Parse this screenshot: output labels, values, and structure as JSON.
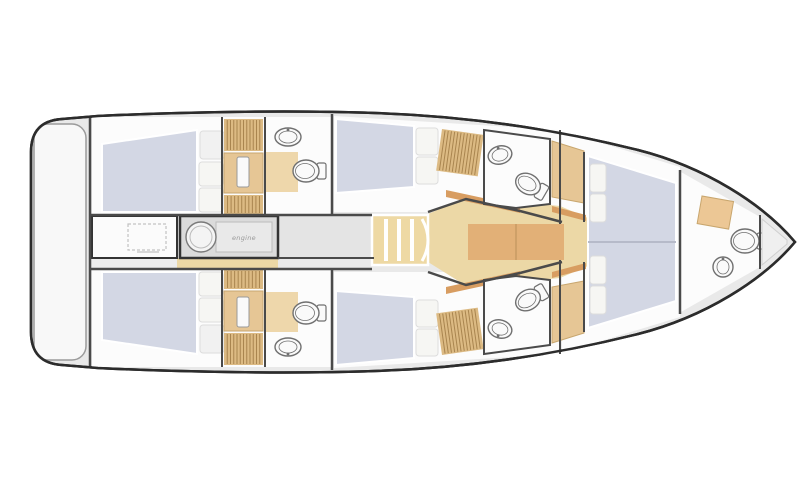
{
  "labels": {
    "engine": "engine"
  },
  "canvas": {
    "width": 810,
    "height": 500,
    "background": "#ffffff"
  },
  "palette": {
    "outline": "#2c2c2c",
    "deck": "#e9e9e9",
    "room": "#fcfcfc",
    "floorGray": "#ededed",
    "corridorGray": "#e4e4e4",
    "bed": "#d3d7e4",
    "pillow": "#f6f6f3",
    "wood": "#dcba83",
    "woodLight": "#ecd8a6",
    "woodDark": "#d89d61",
    "woodSlat": "#a9854f",
    "cabinetTan": "#e6c695",
    "fixture": "#fafafa",
    "fixtureStroke": "#707070",
    "wall": "#4a4a4a",
    "boxStroke": "#333333"
  },
  "scene": [
    {
      "name": "hull-deck",
      "kind": "path",
      "attrs": {
        "d": "M795,242 C763,204 705,167 638,150 C558,130 468,116 375,113 C290,110 180,112 98,116 L62,119 Q31,121 31,152 L31,332 Q31,363 62,365 L98,368 C180,372 290,374 375,371 C468,368 558,354 638,334 C705,317 763,280 795,242 Z",
        "fill": "deck",
        "stroke": "outline",
        "sw": 2.5
      }
    },
    {
      "name": "transom-platform",
      "kind": "rect",
      "attrs": {
        "x": 34,
        "y": 124,
        "w": 52,
        "h": 236,
        "rx": 14,
        "fill": "#f8f8f8",
        "stroke": "#9b9b9b",
        "sw": 1.5
      }
    },
    {
      "name": "aft-cabin",
      "kind": "rect",
      "mirror": true,
      "attrs": {
        "x": 92,
        "y": 117,
        "w": 130,
        "h": 98,
        "fill": "room"
      }
    },
    {
      "name": "aft-stairs-lobby",
      "kind": "rect",
      "mirror": true,
      "attrs": {
        "x": 222,
        "y": 117,
        "w": 43,
        "h": 98,
        "fill": "room"
      }
    },
    {
      "name": "aft-head",
      "kind": "rect",
      "mirror": true,
      "attrs": {
        "x": 265,
        "y": 117,
        "w": 67,
        "h": 98,
        "fill": "room"
      }
    },
    {
      "name": "mid-cabin",
      "kind": "polygon",
      "mirror": true,
      "attrs": {
        "points": "334,116 560,130 560,212 334,212",
        "fill": "room"
      }
    },
    {
      "name": "fwd-cabin",
      "kind": "polygon",
      "attrs": {
        "points": "562,131 680,167 680,317 562,353",
        "fill": "room"
      }
    },
    {
      "name": "bow-head",
      "kind": "polygon",
      "attrs": {
        "points": "681,172 760,217 760,267 681,312",
        "fill": "room"
      }
    },
    {
      "name": "corridor-floor",
      "kind": "rect",
      "attrs": {
        "x": 278,
        "y": 216,
        "w": 96,
        "h": 42,
        "fill": "corridorGray"
      }
    },
    {
      "name": "aft-strip-gray",
      "kind": "rect",
      "attrs": {
        "x": 92,
        "y": 258,
        "w": 85,
        "h": 12,
        "fill": "floorGray"
      }
    },
    {
      "name": "aft-strip-wood",
      "kind": "rect",
      "attrs": {
        "x": 177,
        "y": 258,
        "w": 101,
        "h": 12,
        "fill": "woodLight"
      }
    },
    {
      "name": "saloon-floor",
      "kind": "polygon",
      "attrs": {
        "points": "428,214 468,197 560,206 588,218 588,266 560,278 468,287 428,262",
        "fill": "woodLight"
      }
    },
    {
      "name": "saloon-table",
      "kind": "rect",
      "attrs": {
        "x": 468,
        "y": 224,
        "w": 96,
        "h": 36,
        "fill": "#e2b077"
      }
    },
    {
      "name": "saloon-table-line",
      "kind": "line",
      "attrs": {
        "x1": 516,
        "y1": 224,
        "x2": 516,
        "y2": 260,
        "stroke": "#c79a63",
        "sw": 1.5
      }
    },
    {
      "name": "cabin-bulkhead-bar",
      "kind": "polygon",
      "mirror": true,
      "attrs": {
        "points": "446,190 520,206 520,213 446,197",
        "fill": "woodDark"
      }
    },
    {
      "name": "fwd-bulkhead-bar",
      "kind": "polygon",
      "mirror": true,
      "attrs": {
        "points": "552,206 586,215 586,221 552,212",
        "fill": "woodDark"
      }
    },
    {
      "name": "aft-berth",
      "kind": "polygon",
      "mirror": true,
      "attrs": {
        "points": "102,144 197,130 197,212 102,212",
        "fill": "bed",
        "stroke": "#ffffff",
        "sw": 2
      }
    },
    {
      "name": "aft-berth-pillow-1",
      "kind": "rect",
      "mirror": true,
      "attrs": {
        "x": 199,
        "y": 162,
        "w": 24,
        "h": 24,
        "rx": 3,
        "fill": "pillow",
        "stroke": "#dddddd",
        "sw": 1
      }
    },
    {
      "name": "aft-berth-pillow-2",
      "kind": "rect",
      "mirror": true,
      "attrs": {
        "x": 199,
        "y": 188,
        "w": 24,
        "h": 24,
        "rx": 3,
        "fill": "pillow",
        "stroke": "#dddddd",
        "sw": 1
      }
    },
    {
      "name": "aft-berth-headboard",
      "kind": "rect",
      "mirror": true,
      "attrs": {
        "x": 200,
        "y": 131,
        "w": 24,
        "h": 28,
        "rx": 3,
        "fill": "#f1f1f1",
        "stroke": "#dddddd",
        "sw": 1
      }
    },
    {
      "name": "aft-companionway-ladder",
      "kind": "slats",
      "mirror": true,
      "attrs": {
        "x": 224,
        "y": 119,
        "w": 39,
        "h": 32,
        "n": 11,
        "fill": "wood"
      }
    },
    {
      "name": "aft-wardrobe",
      "kind": "rect",
      "mirror": true,
      "attrs": {
        "x": 224,
        "y": 153,
        "w": 39,
        "h": 40,
        "fill": "cabinetTan",
        "stroke": "#c8a66e",
        "sw": 1
      }
    },
    {
      "name": "aft-wardrobe-door",
      "kind": "rect",
      "mirror": true,
      "attrs": {
        "x": 237,
        "y": 157,
        "w": 12,
        "h": 30,
        "rx": 2,
        "fill": "#fafafa",
        "stroke": "#999999",
        "sw": 1
      }
    },
    {
      "name": "aft-steps",
      "kind": "slats",
      "mirror": true,
      "attrs": {
        "x": 224,
        "y": 195,
        "w": 39,
        "h": 19,
        "n": 10,
        "fill": "wood"
      }
    },
    {
      "name": "aft-head-mat",
      "kind": "rect",
      "mirror": true,
      "attrs": {
        "x": 266,
        "y": 152,
        "w": 32,
        "h": 40,
        "fill": "#eed7ab"
      }
    },
    {
      "name": "aft-head-sink",
      "kind": "sink",
      "mirror": true,
      "attrs": {
        "cx": 288,
        "cy": 137,
        "rx": 13,
        "ry": 9
      }
    },
    {
      "name": "aft-head-toilet",
      "kind": "toilet",
      "mirror": true,
      "attrs": {
        "cx": 306,
        "cy": 171,
        "rx": 11,
        "ry": 13,
        "rot": 90
      }
    },
    {
      "name": "mid-berth",
      "kind": "polygon",
      "mirror": true,
      "attrs": {
        "points": "336,119 414,126 414,187 336,193",
        "fill": "bed",
        "stroke": "#ffffff",
        "sw": 2
      }
    },
    {
      "name": "mid-berth-pillow-1",
      "kind": "rect",
      "mirror": true,
      "attrs": {
        "x": 416,
        "y": 128,
        "w": 22,
        "h": 27,
        "rx": 3,
        "fill": "pillow",
        "stroke": "#dddddd",
        "sw": 1
      }
    },
    {
      "name": "mid-berth-pillow-2",
      "kind": "rect",
      "mirror": true,
      "attrs": {
        "x": 416,
        "y": 157,
        "w": 22,
        "h": 27,
        "rx": 3,
        "fill": "pillow",
        "stroke": "#dddddd",
        "sw": 1
      }
    },
    {
      "name": "mid-wardrobe",
      "kind": "slats",
      "mirror": true,
      "attrs": {
        "x": 442,
        "y": 129,
        "w": 42,
        "h": 42,
        "n": 12,
        "rot": 8,
        "fill": "wood"
      }
    },
    {
      "name": "mid-head",
      "kind": "polygon",
      "mirror": true,
      "attrs": {
        "points": "484,130 550,139 550,204 516,208 484,204",
        "fill": "room",
        "stroke": "wall",
        "sw": 2
      }
    },
    {
      "name": "mid-head-sink",
      "kind": "sink",
      "mirror": true,
      "attrs": {
        "cx": 500,
        "cy": 155,
        "rx": 12,
        "ry": 9,
        "rot": -15
      }
    },
    {
      "name": "mid-head-toilet",
      "kind": "toilet",
      "mirror": true,
      "attrs": {
        "cx": 528,
        "cy": 184,
        "rx": 10,
        "ry": 13,
        "rot": 120
      }
    },
    {
      "name": "mid-locker",
      "kind": "polygon",
      "mirror": true,
      "attrs": {
        "points": "552,141 584,151 584,203 552,197",
        "fill": "cabinetTan",
        "stroke": "#c8a66e",
        "sw": 1
      }
    },
    {
      "name": "companionway-stairs",
      "kind": "rect",
      "attrs": {
        "x": 372,
        "y": 215,
        "w": 56,
        "h": 50,
        "fill": "#eed9a4",
        "stroke": "#ffffff",
        "sw": 2.5
      }
    },
    {
      "name": "stair-tread-1",
      "kind": "rect",
      "attrs": {
        "x": 384,
        "y": 219,
        "w": 4,
        "h": 42,
        "fill": "#ffffff"
      }
    },
    {
      "name": "stair-tread-2",
      "kind": "rect",
      "attrs": {
        "x": 397,
        "y": 219,
        "w": 4,
        "h": 42,
        "fill": "#ffffff"
      }
    },
    {
      "name": "stair-tread-3",
      "kind": "rect",
      "attrs": {
        "x": 410,
        "y": 219,
        "w": 4,
        "h": 42,
        "fill": "#ffffff"
      }
    },
    {
      "name": "stair-cap",
      "kind": "path",
      "attrs": {
        "d": "M422,219 Q434,240 422,261",
        "fill": "none",
        "stroke": "#ffffff",
        "sw": 3
      }
    },
    {
      "name": "fwd-berth",
      "kind": "polygon",
      "attrs": {
        "points": "588,156 676,183 676,301 588,328",
        "fill": "bed",
        "stroke": "#ffffff",
        "sw": 2
      }
    },
    {
      "name": "fwd-berth-split",
      "kind": "line",
      "attrs": {
        "x1": 588,
        "y1": 242,
        "x2": 676,
        "y2": 242,
        "stroke": "#b6bac9",
        "sw": 2
      }
    },
    {
      "name": "fwd-berth-pillow-1",
      "kind": "rect",
      "attrs": {
        "x": 590,
        "y": 164,
        "w": 16,
        "h": 28,
        "rx": 3,
        "fill": "pillow",
        "stroke": "#dddddd",
        "sw": 1
      }
    },
    {
      "name": "fwd-berth-pillow-2",
      "kind": "rect",
      "attrs": {
        "x": 590,
        "y": 194,
        "w": 16,
        "h": 28,
        "rx": 3,
        "fill": "pillow",
        "stroke": "#dddddd",
        "sw": 1
      }
    },
    {
      "name": "fwd-berth-pillow-3",
      "kind": "rect",
      "attrs": {
        "x": 590,
        "y": 256,
        "w": 16,
        "h": 28,
        "rx": 3,
        "fill": "pillow",
        "stroke": "#dddddd",
        "sw": 1
      }
    },
    {
      "name": "fwd-berth-pillow-4",
      "kind": "rect",
      "attrs": {
        "x": 590,
        "y": 286,
        "w": 16,
        "h": 28,
        "rx": 3,
        "fill": "pillow",
        "stroke": "#dddddd",
        "sw": 1
      }
    },
    {
      "name": "bow-cabinet",
      "kind": "rect",
      "attrs": {
        "x": 702,
        "y": 196,
        "w": 32,
        "h": 28,
        "rot": 10,
        "fill": "#ecc795",
        "stroke": "#c8a66e",
        "sw": 1
      }
    },
    {
      "name": "bow-toilet",
      "kind": "toilet",
      "attrs": {
        "cx": 745,
        "cy": 241,
        "rx": 12,
        "ry": 14,
        "rot": 90
      }
    },
    {
      "name": "bow-sink",
      "kind": "sink",
      "attrs": {
        "cx": 723,
        "cy": 267,
        "rx": 10,
        "ry": 10
      }
    },
    {
      "name": "bow-fwd-wall",
      "kind": "line",
      "attrs": {
        "x1": 760,
        "y1": 215,
        "x2": 760,
        "y2": 269,
        "stroke": "wall",
        "sw": 2
      }
    },
    {
      "name": "anchor-locker",
      "kind": "polygon",
      "attrs": {
        "points": "762,219 787,240 787,244 762,265",
        "fill": "#efefef",
        "stroke": "#cfcfcf",
        "sw": 1
      }
    },
    {
      "name": "galley-module",
      "kind": "rect",
      "attrs": {
        "x": 92,
        "y": 216,
        "w": 85,
        "h": 42,
        "fill": "#fbfbfb",
        "stroke": "boxStroke",
        "sw": 2
      }
    },
    {
      "name": "galley-hatch-dashed",
      "kind": "rect",
      "attrs": {
        "x": 128,
        "y": 224,
        "w": 38,
        "h": 26,
        "fill": "none",
        "stroke": "#c2c2c2",
        "sw": 1.2,
        "dash": "3,2"
      }
    },
    {
      "name": "galley-caption-marks",
      "kind": "rect",
      "attrs": {
        "x": 137,
        "y": 251,
        "w": 22,
        "h": 2,
        "fill": "#d8d8d8"
      }
    },
    {
      "name": "engine-room",
      "kind": "rect",
      "attrs": {
        "x": 180,
        "y": 216,
        "w": 98,
        "h": 42,
        "fill": "#dbdbdb",
        "stroke": "boxStroke",
        "sw": 2.5
      }
    },
    {
      "name": "engine-panel",
      "kind": "rect",
      "attrs": {
        "x": 216,
        "y": 222,
        "w": 56,
        "h": 30,
        "fill": "#e9e9e9",
        "stroke": "#bcbcbc",
        "sw": 1
      }
    },
    {
      "name": "engine-generator",
      "kind": "circle",
      "attrs": {
        "cx": 201,
        "cy": 237,
        "r": 15,
        "fill": "#f4f4f4",
        "stroke": "#7a7a7a",
        "sw": 1.4
      }
    },
    {
      "name": "engine-generator-inner",
      "kind": "circle",
      "attrs": {
        "cx": 201,
        "cy": 237,
        "r": 11,
        "fill": "none",
        "stroke": "#bbbbbb",
        "sw": 1
      }
    },
    {
      "name": "wall-transom-bulkhead",
      "kind": "line",
      "attrs": {
        "x1": 90,
        "y1": 116,
        "x2": 90,
        "y2": 368,
        "stroke": "wall",
        "sw": 2.5
      }
    },
    {
      "name": "wall-aft-center",
      "kind": "line",
      "mirror": true,
      "attrs": {
        "x1": 90,
        "y1": 215,
        "x2": 372,
        "y2": 215,
        "stroke": "wall",
        "sw": 2.5
      }
    },
    {
      "name": "wall-corridor-lower",
      "kind": "line",
      "attrs": {
        "x1": 278,
        "y1": 258,
        "x2": 374,
        "y2": 258,
        "stroke": "wall",
        "sw": 2
      }
    },
    {
      "name": "wall-aft-cabin",
      "kind": "line",
      "mirror": true,
      "attrs": {
        "x1": 222,
        "y1": 117,
        "x2": 222,
        "y2": 215,
        "stroke": "wall",
        "sw": 2
      }
    },
    {
      "name": "wall-aft-head",
      "kind": "line",
      "mirror": true,
      "attrs": {
        "x1": 265,
        "y1": 117,
        "x2": 265,
        "y2": 215,
        "stroke": "wall",
        "sw": 2
      }
    },
    {
      "name": "wall-mid-bulkhead",
      "kind": "line",
      "mirror": true,
      "attrs": {
        "x1": 332,
        "y1": 114,
        "x2": 332,
        "y2": 215,
        "stroke": "wall",
        "sw": 2.5
      }
    },
    {
      "name": "wall-mid-angled",
      "kind": "polyline",
      "mirror": true,
      "attrs": {
        "points": "428,212 466,199 520,211 562,222",
        "stroke": "wall",
        "sw": 2.5
      }
    },
    {
      "name": "wall-fwd-bulkhead",
      "kind": "line",
      "mirror": true,
      "attrs": {
        "x1": 560,
        "y1": 130,
        "x2": 560,
        "y2": 224,
        "stroke": "wall",
        "sw": 2
      }
    },
    {
      "name": "wall-fwd-cabin-upper",
      "kind": "line",
      "attrs": {
        "x1": 584,
        "y1": 152,
        "x2": 584,
        "y2": 222,
        "stroke": "wall",
        "sw": 2
      }
    },
    {
      "name": "wall-fwd-cabin-lower",
      "kind": "line",
      "attrs": {
        "x1": 584,
        "y1": 262,
        "x2": 584,
        "y2": 332,
        "stroke": "wall",
        "sw": 2
      }
    },
    {
      "name": "wall-bow-bulkhead",
      "kind": "line",
      "attrs": {
        "x1": 680,
        "y1": 170,
        "x2": 680,
        "y2": 314,
        "stroke": "wall",
        "sw": 2.5
      }
    },
    {
      "name": "hull-outline",
      "kind": "path",
      "attrs": {
        "d": "M795,242 C763,204 705,167 638,150 C558,130 468,116 375,113 C290,110 180,112 98,116 L62,119 Q31,121 31,152 L31,332 Q31,363 62,365 L98,368 C180,372 290,374 375,371 C468,368 558,354 638,334 C705,317 763,280 795,242 Z",
        "fill": "none",
        "stroke": "outline",
        "sw": 2.5
      }
    }
  ]
}
